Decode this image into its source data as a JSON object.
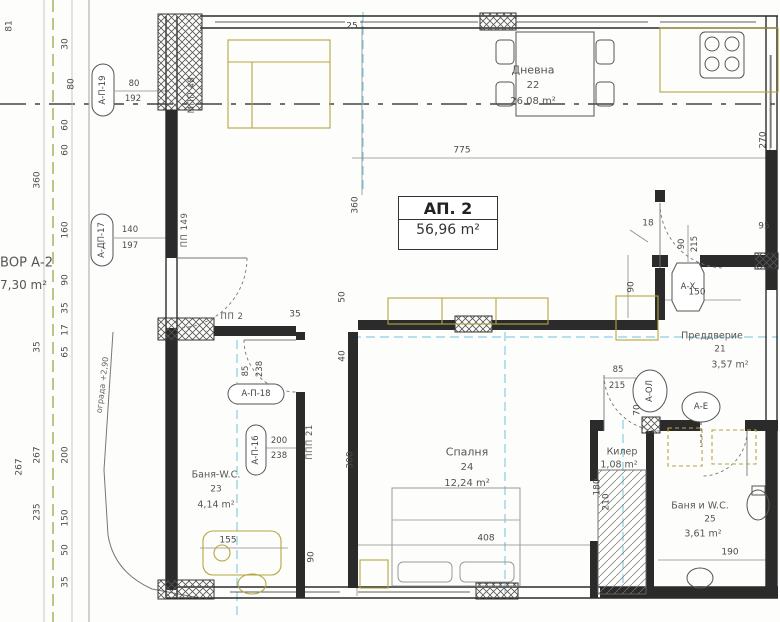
{
  "apartment": {
    "title": "АП. 2",
    "area": "56,96 m²"
  },
  "rooms": [
    {
      "name": "Дневна",
      "number": "22",
      "area": "26,08 m²"
    },
    {
      "name": "Спалня",
      "number": "24",
      "area": "12,24 m²"
    },
    {
      "name": "Преддверие",
      "number": "21",
      "area": "3,57 m²"
    },
    {
      "name": "Килер",
      "number": "",
      "area": "1,08 m²"
    },
    {
      "name": "Баня и W.C.",
      "number": "25",
      "area": "3,61 m²"
    },
    {
      "name": "Баня-W.C.",
      "number": "23",
      "area": "4,14 m²"
    },
    {
      "name": "ВОР А-2",
      "number": "",
      "area": "7,30 m²"
    }
  ],
  "callouts": [
    {
      "id": "А-П-19",
      "w": "80",
      "h": "192"
    },
    {
      "id": "А-ДП-17",
      "w": "140",
      "h": "197"
    },
    {
      "id": "А-П-18",
      "w": "85",
      "h": "238"
    },
    {
      "id": "А-П-16",
      "w": "200",
      "h": "238"
    },
    {
      "id": "А-Х",
      "w": "90",
      "h": "215"
    },
    {
      "id": "А-ОЛ",
      "w": "85",
      "h": "215"
    },
    {
      "id": "А-Е",
      "w": "",
      "h": ""
    }
  ],
  "wall_codes": [
    "МПП 48",
    "ПП 149",
    "ПП 2",
    "ППП 21"
  ],
  "dims": [
    "775",
    "360",
    "300",
    "408",
    "270",
    "25",
    "30",
    "80",
    "60",
    "60",
    "160",
    "90",
    "35",
    "17",
    "65",
    "200",
    "150",
    "50",
    "35",
    "360",
    "35",
    "267",
    "235",
    "267",
    "81",
    "150",
    "95",
    "18",
    "90",
    "70",
    "190",
    "155",
    "35",
    "50",
    "40",
    "90",
    "180",
    "210"
  ],
  "notes": {
    "level": "ограда +2,90"
  },
  "colors": {
    "wall": "#2b2b2b",
    "axis": "#6fc2e0",
    "furniture": "#b5a642",
    "thin": "#6a6a6a"
  }
}
